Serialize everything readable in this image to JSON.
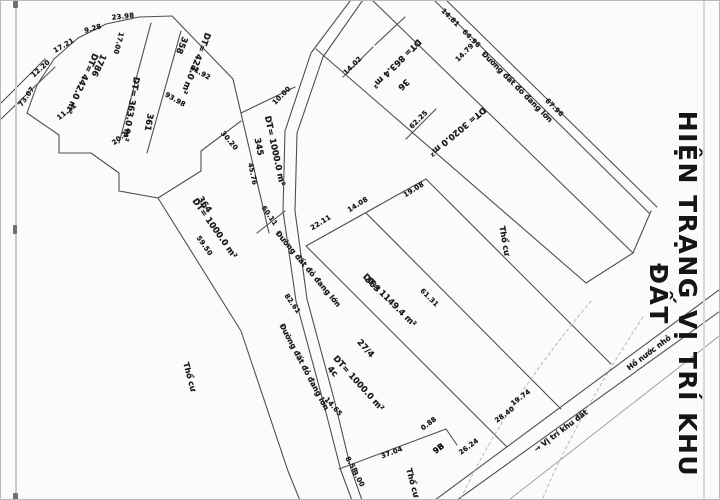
{
  "title": {
    "text": "HIỆN TRẠNG VỊ TRÍ KHU ĐẤT"
  },
  "colors": {
    "background": "#fbfbfb",
    "line": "#4f4f4f",
    "text": "#1b1b1b"
  },
  "map": {
    "area_labels": [
      {
        "text": "DT= 442.0 m²",
        "x": 80,
        "y": 82,
        "rot": 115
      },
      {
        "text": "1786",
        "x": 97,
        "y": 64,
        "rot": 115
      },
      {
        "text": "DT= 363.0 m²",
        "x": 129,
        "y": 108,
        "rot": 100
      },
      {
        "text": "361",
        "x": 147,
        "y": 121,
        "rot": 100
      },
      {
        "text": "DT= 423.0 m²",
        "x": 194,
        "y": 62,
        "rot": 112
      },
      {
        "text": "358",
        "x": 180,
        "y": 44,
        "rot": 112
      },
      {
        "text": "DT= 1000.0 m²",
        "x": 273,
        "y": 150,
        "rot": 78
      },
      {
        "text": "345",
        "x": 257,
        "y": 146,
        "rot": 78
      },
      {
        "text": "DT= 1000.0 m²",
        "x": 213,
        "y": 228,
        "rot": 55
      },
      {
        "text": "364",
        "x": 203,
        "y": 204,
        "rot": 55
      },
      {
        "text": "DT= 1149.4 m²",
        "x": 388,
        "y": 300,
        "rot": 45
      },
      {
        "text": "363",
        "x": 371,
        "y": 284,
        "rot": 45
      },
      {
        "text": "DT= 1000.0 m²",
        "x": 357,
        "y": 383,
        "rot": 48
      },
      {
        "text": "4c",
        "x": 331,
        "y": 371,
        "rot": 48
      },
      {
        "text": "27/4",
        "x": 364,
        "y": 348,
        "rot": 48
      },
      {
        "text": "DT= 863.4 m²",
        "x": 395,
        "y": 62,
        "rot": 135
      },
      {
        "text": "36",
        "x": 402,
        "y": 83,
        "rot": 135
      },
      {
        "text": "DT= 3020.0 m²",
        "x": 456,
        "y": 130,
        "rot": 140
      }
    ],
    "landuse_labels": [
      {
        "text": "Thổ cư",
        "x": 503,
        "y": 240,
        "rot": 80
      },
      {
        "text": "Thổ cư",
        "x": 188,
        "y": 376,
        "rot": 75
      },
      {
        "text": "Thổ cư",
        "x": 411,
        "y": 482,
        "rot": 75
      }
    ],
    "road_labels": [
      {
        "text": "Đường đất đỏ đang lớn",
        "x": 516,
        "y": 86,
        "rot": 45
      },
      {
        "text": "Đường đất đỏ đang lớn",
        "x": 307,
        "y": 268,
        "rot": 50
      },
      {
        "text": "Đường đất đỏ đang lớn",
        "x": 303,
        "y": 366,
        "rot": 62
      },
      {
        "text": "Hồ nước nhỏ",
        "x": 648,
        "y": 352,
        "rot": -37
      },
      {
        "text": "→ Vị trí khu đất",
        "x": 560,
        "y": 430,
        "rot": -37
      }
    ],
    "measurements": [
      {
        "text": "73.07",
        "x": 26,
        "y": 96,
        "rot": -55
      },
      {
        "text": "12.20",
        "x": 40,
        "y": 68,
        "rot": -42
      },
      {
        "text": "17.21",
        "x": 63,
        "y": 45,
        "rot": -30
      },
      {
        "text": "9.28",
        "x": 92,
        "y": 28,
        "rot": -16
      },
      {
        "text": "23.98",
        "x": 122,
        "y": 16,
        "rot": -6
      },
      {
        "text": "17.00",
        "x": 117,
        "y": 42,
        "rot": 105
      },
      {
        "text": "11.11",
        "x": 66,
        "y": 111,
        "rot": -38
      },
      {
        "text": "20.20",
        "x": 121,
        "y": 136,
        "rot": -38
      },
      {
        "text": "30.20",
        "x": 228,
        "y": 140,
        "rot": 50
      },
      {
        "text": "61.92",
        "x": 199,
        "y": 72,
        "rot": 30
      },
      {
        "text": "93.98",
        "x": 174,
        "y": 99,
        "rot": 30
      },
      {
        "text": "10.00",
        "x": 281,
        "y": 95,
        "rot": -45
      },
      {
        "text": "45.76",
        "x": 251,
        "y": 173,
        "rot": 78
      },
      {
        "text": "59.50",
        "x": 203,
        "y": 245,
        "rot": 55
      },
      {
        "text": "60.11",
        "x": 268,
        "y": 215,
        "rot": 55
      },
      {
        "text": "82.61",
        "x": 291,
        "y": 303,
        "rot": 55
      },
      {
        "text": "22.11",
        "x": 320,
        "y": 222,
        "rot": -32
      },
      {
        "text": "14.08",
        "x": 357,
        "y": 204,
        "rot": -32
      },
      {
        "text": "19.08",
        "x": 413,
        "y": 189,
        "rot": -32
      },
      {
        "text": "61.31",
        "x": 428,
        "y": 297,
        "rot": 45
      },
      {
        "text": "14.65",
        "x": 332,
        "y": 406,
        "rot": 48
      },
      {
        "text": "8.58",
        "x": 350,
        "y": 464,
        "rot": 60
      },
      {
        "text": "3.00",
        "x": 357,
        "y": 478,
        "rot": 60
      },
      {
        "text": "14.81",
        "x": 449,
        "y": 17,
        "rot": 45
      },
      {
        "text": "14.79",
        "x": 464,
        "y": 52,
        "rot": -45
      },
      {
        "text": "64.96",
        "x": 470,
        "y": 38,
        "rot": 45
      },
      {
        "text": "67.96",
        "x": 553,
        "y": 107,
        "rot": 45
      },
      {
        "text": "14.02",
        "x": 352,
        "y": 65,
        "rot": -45
      },
      {
        "text": "62.25",
        "x": 418,
        "y": 119,
        "rot": -45
      },
      {
        "text": "37.04",
        "x": 391,
        "y": 452,
        "rot": -21
      },
      {
        "text": "0.88",
        "x": 428,
        "y": 423,
        "rot": -37
      },
      {
        "text": "26.24",
        "x": 468,
        "y": 446,
        "rot": -37
      },
      {
        "text": "28.40",
        "x": 504,
        "y": 414,
        "rot": -37
      },
      {
        "text": "19.74",
        "x": 520,
        "y": 397,
        "rot": -37
      }
    ],
    "symbols": [
      {
        "text": "9B",
        "x": 438,
        "y": 448,
        "rot": -37
      }
    ]
  }
}
